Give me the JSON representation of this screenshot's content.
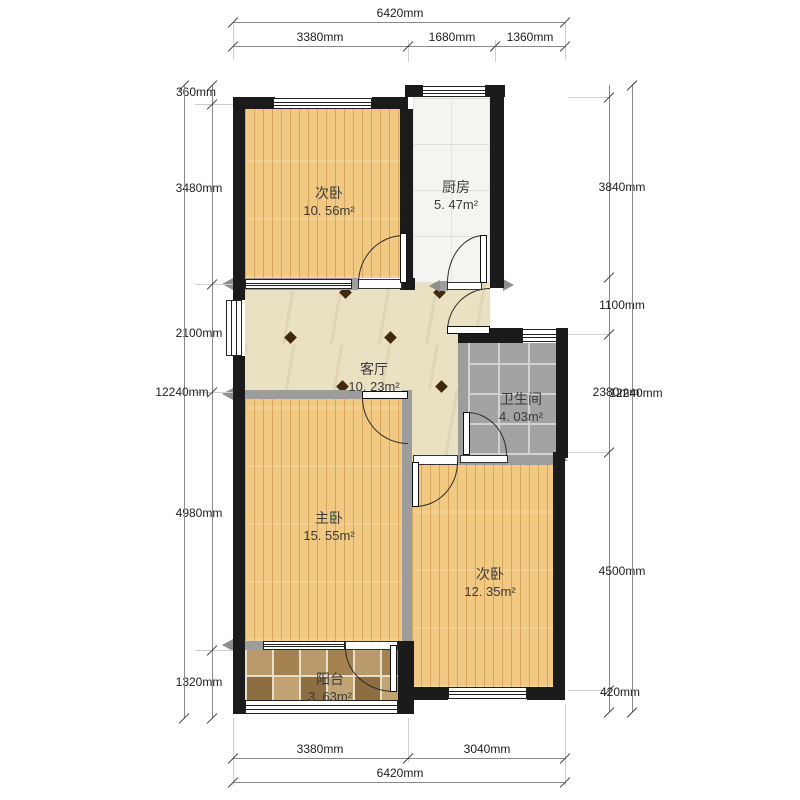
{
  "rooms": [
    {
      "id": "bedroom-top",
      "name": "次卧",
      "area": "10. 56m²"
    },
    {
      "id": "kitchen",
      "name": "厨房",
      "area": "5. 47m²"
    },
    {
      "id": "living-room",
      "name": "客厅",
      "area": "10. 23m²"
    },
    {
      "id": "bathroom",
      "name": "卫生间",
      "area": "4. 03m²"
    },
    {
      "id": "master-bedroom",
      "name": "主卧",
      "area": "15. 55m²"
    },
    {
      "id": "bedroom-right",
      "name": "次卧",
      "area": "12. 35m²"
    },
    {
      "id": "balcony",
      "name": "阳台",
      "area": "3. 63m²"
    }
  ],
  "dimensions": {
    "top": {
      "overall": "6420mm",
      "segments": [
        "3380mm",
        "1680mm",
        "1360mm"
      ]
    },
    "bottom": {
      "overall": "6420mm",
      "segments": [
        "3380mm",
        "3040mm"
      ]
    },
    "left": {
      "overall": "12240mm",
      "segments": [
        "360mm",
        "3480mm",
        "2100mm",
        "4980mm",
        "1320mm"
      ]
    },
    "right": {
      "overall": "12240mm",
      "segments": [
        "3840mm",
        "1100mm",
        "2380mm",
        "4500mm",
        "420mm"
      ]
    }
  },
  "colors": {
    "exterior_wall": "#1b1b1b",
    "interior_wall": "#9d9d9d",
    "wood_floor": "#f2c983",
    "living_floor": "#eae0c2",
    "bath_tile": "#a3a3a3",
    "balcony_tile": "#b3935f"
  }
}
